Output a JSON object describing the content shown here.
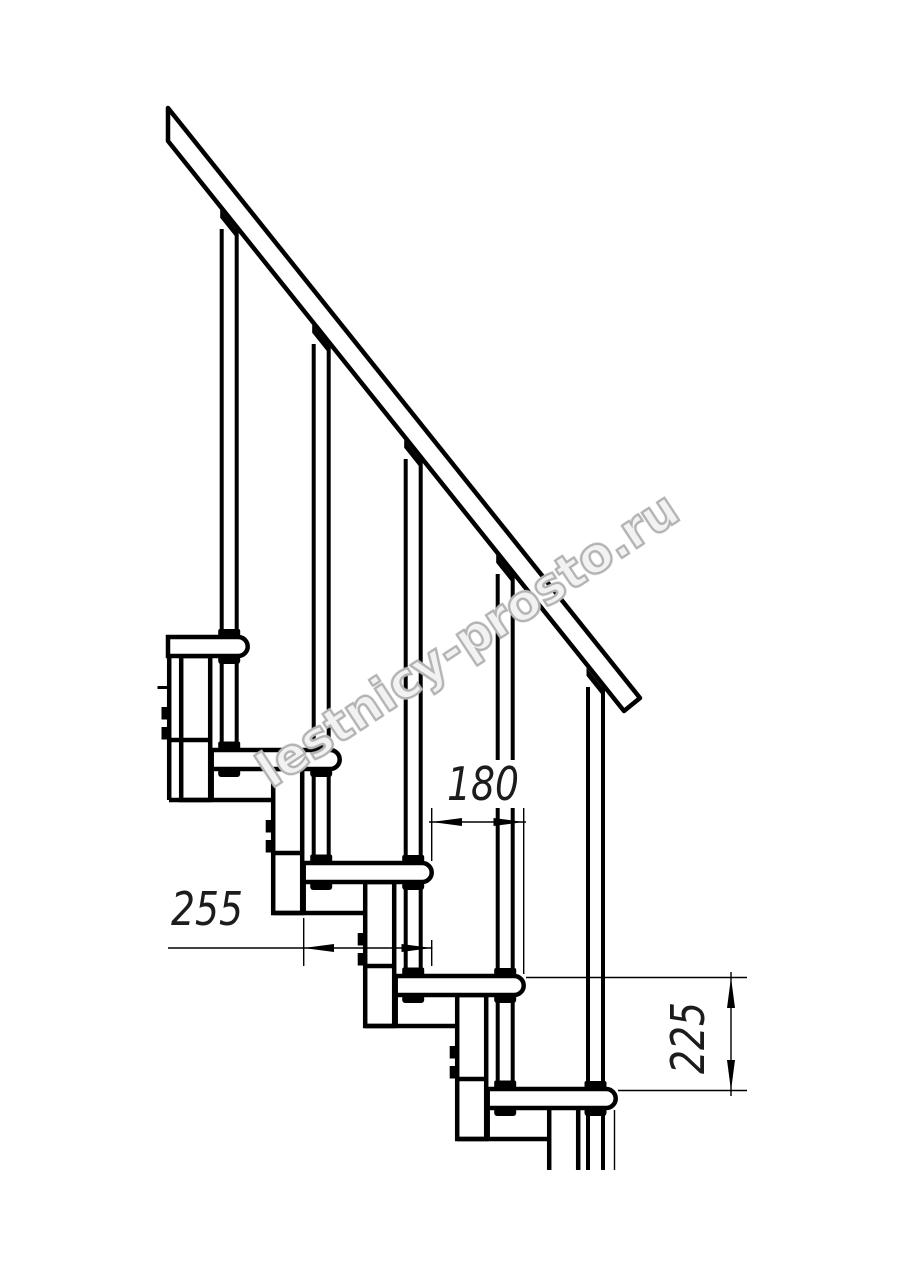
{
  "page": {
    "background": "#ffffff"
  },
  "drawing": {
    "type": "modular-staircase-side-elevation",
    "line_color": "#000000",
    "watermark": {
      "text": "lestnicy-prosto.ru",
      "stroke_color": "#b4b4b4",
      "fill_color": "rgba(255,255,255,0.78)"
    },
    "dimensions": {
      "run": {
        "label": "180"
      },
      "tread_depth": {
        "label": "255"
      },
      "rise": {
        "label": "225"
      }
    }
  }
}
